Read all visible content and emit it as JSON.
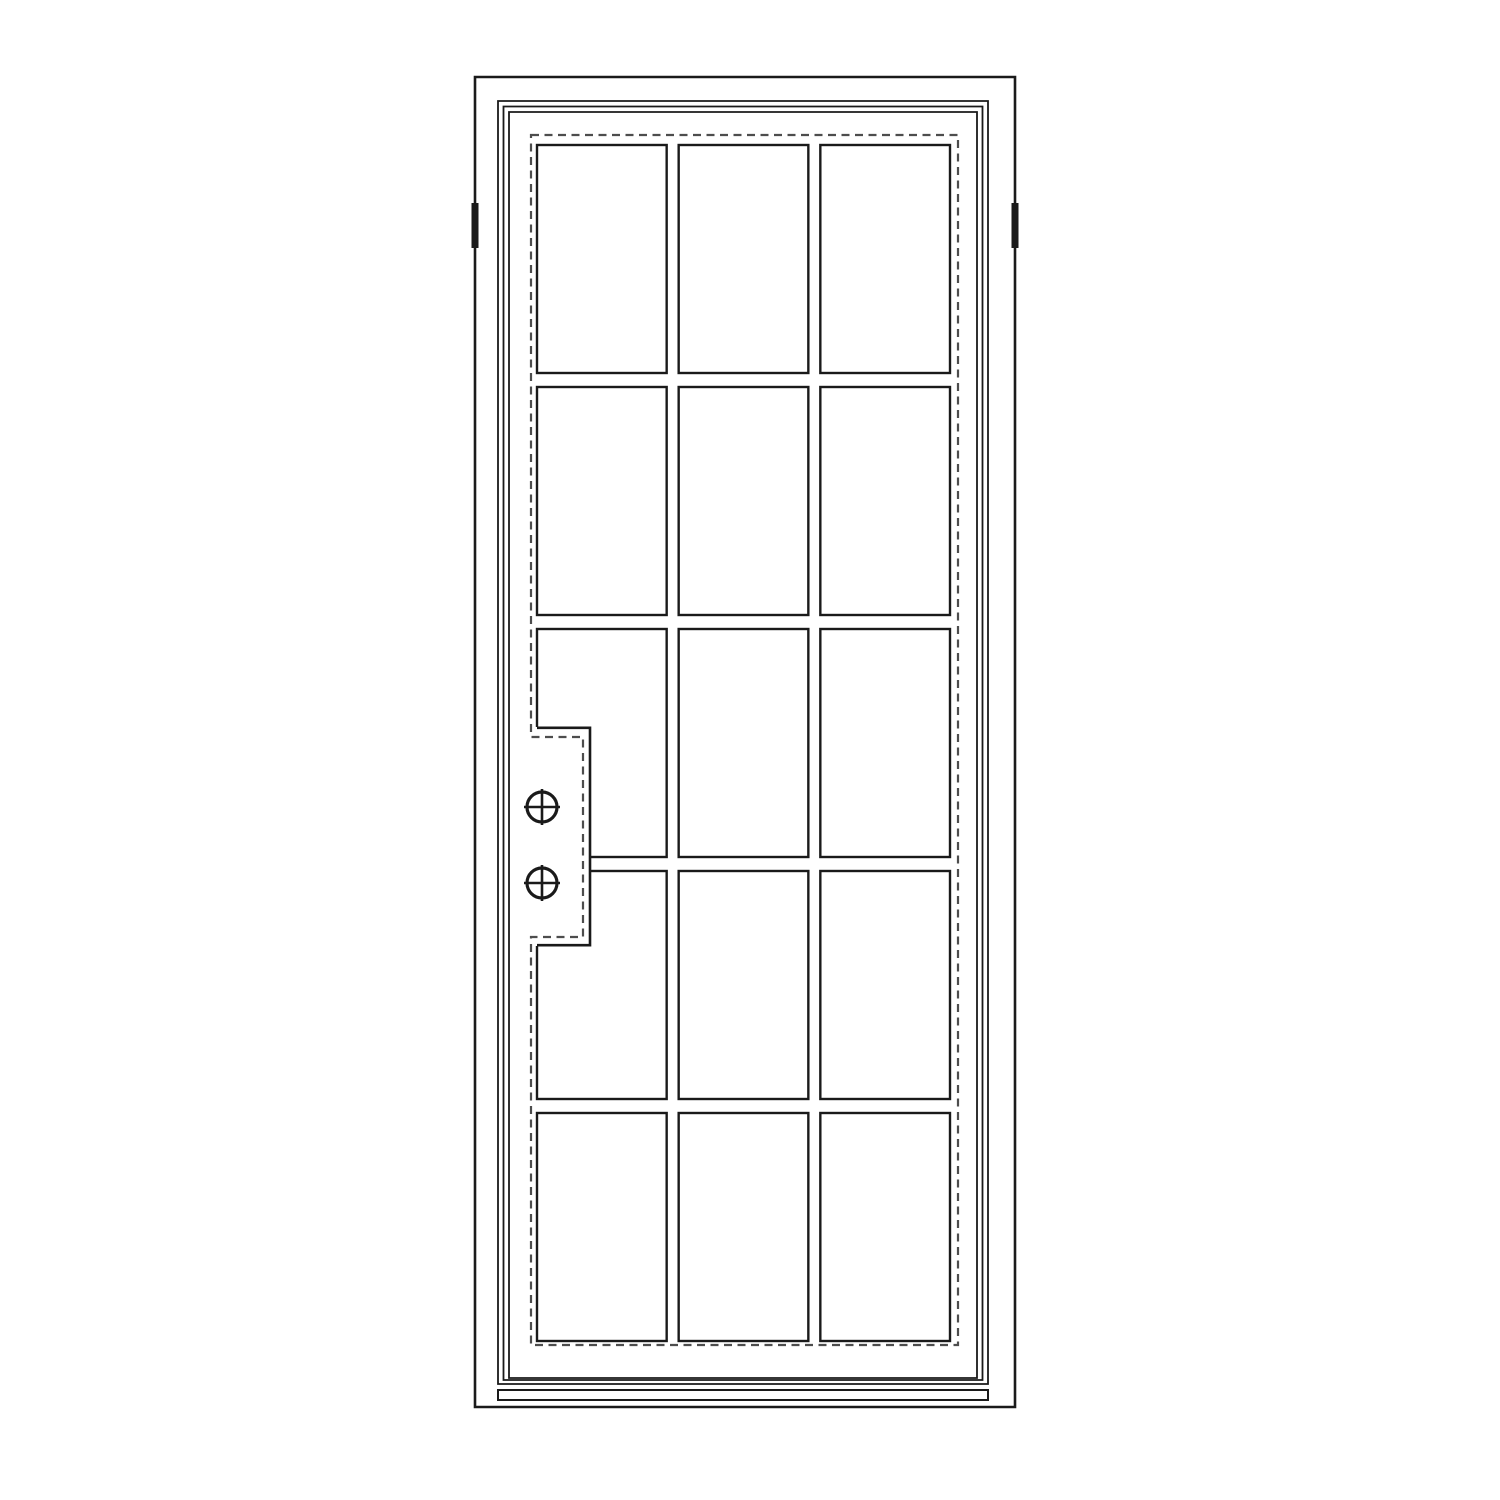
{
  "page": {
    "background_color": "#ffffff"
  },
  "drawing": {
    "kind": "single-door-elevation-line-drawing",
    "line_color": "#1a1a1a",
    "dashed_line_color": "#4d4d4d",
    "canvas": {
      "width": 1500,
      "height": 1500
    },
    "outer_frame": {
      "path": "M475,77 H1015 V1407 H475 Z"
    },
    "jamb_marks": {
      "count": 2,
      "left_path": "M471.5,203 h7 v45 h-7 Z",
      "right_path": "M1011.5,203 h7 v45 h-7 Z"
    },
    "slab_profile_lines": {
      "count": 3,
      "line1_path": "M498,101 H988 V1384 H498 Z",
      "line2_path": "M503.5,106.5 H982.5 V1380 H503.5 Z",
      "line3_path": "M509,112 H977 V1378 H509 Z"
    },
    "sill": {
      "path": "M498,1390 H988 V1400 H498 Z"
    },
    "glazing_gasket_outline": {
      "style": "dashed",
      "path": "M531,135 H958 V1345 H531 V937 H583 V737 H531 Z"
    },
    "glass_grid": {
      "columns": 3,
      "rows": 5,
      "pane_count": 15,
      "x": 537,
      "y": 145,
      "width": 413,
      "height": 1196,
      "column_gap": 12,
      "row_gap": 14
    },
    "lock_box": {
      "cover_path": "M510,727 H590 V946 H510 Z",
      "outline_path": "M537,727.8 H590 V945.2 H537",
      "screw_symbol_count": 2,
      "screws": [
        {
          "cx": 542,
          "cy": 807,
          "r": 15
        },
        {
          "cx": 542,
          "cy": 883,
          "r": 15
        }
      ],
      "screw_cross_overhang": 3
    }
  }
}
